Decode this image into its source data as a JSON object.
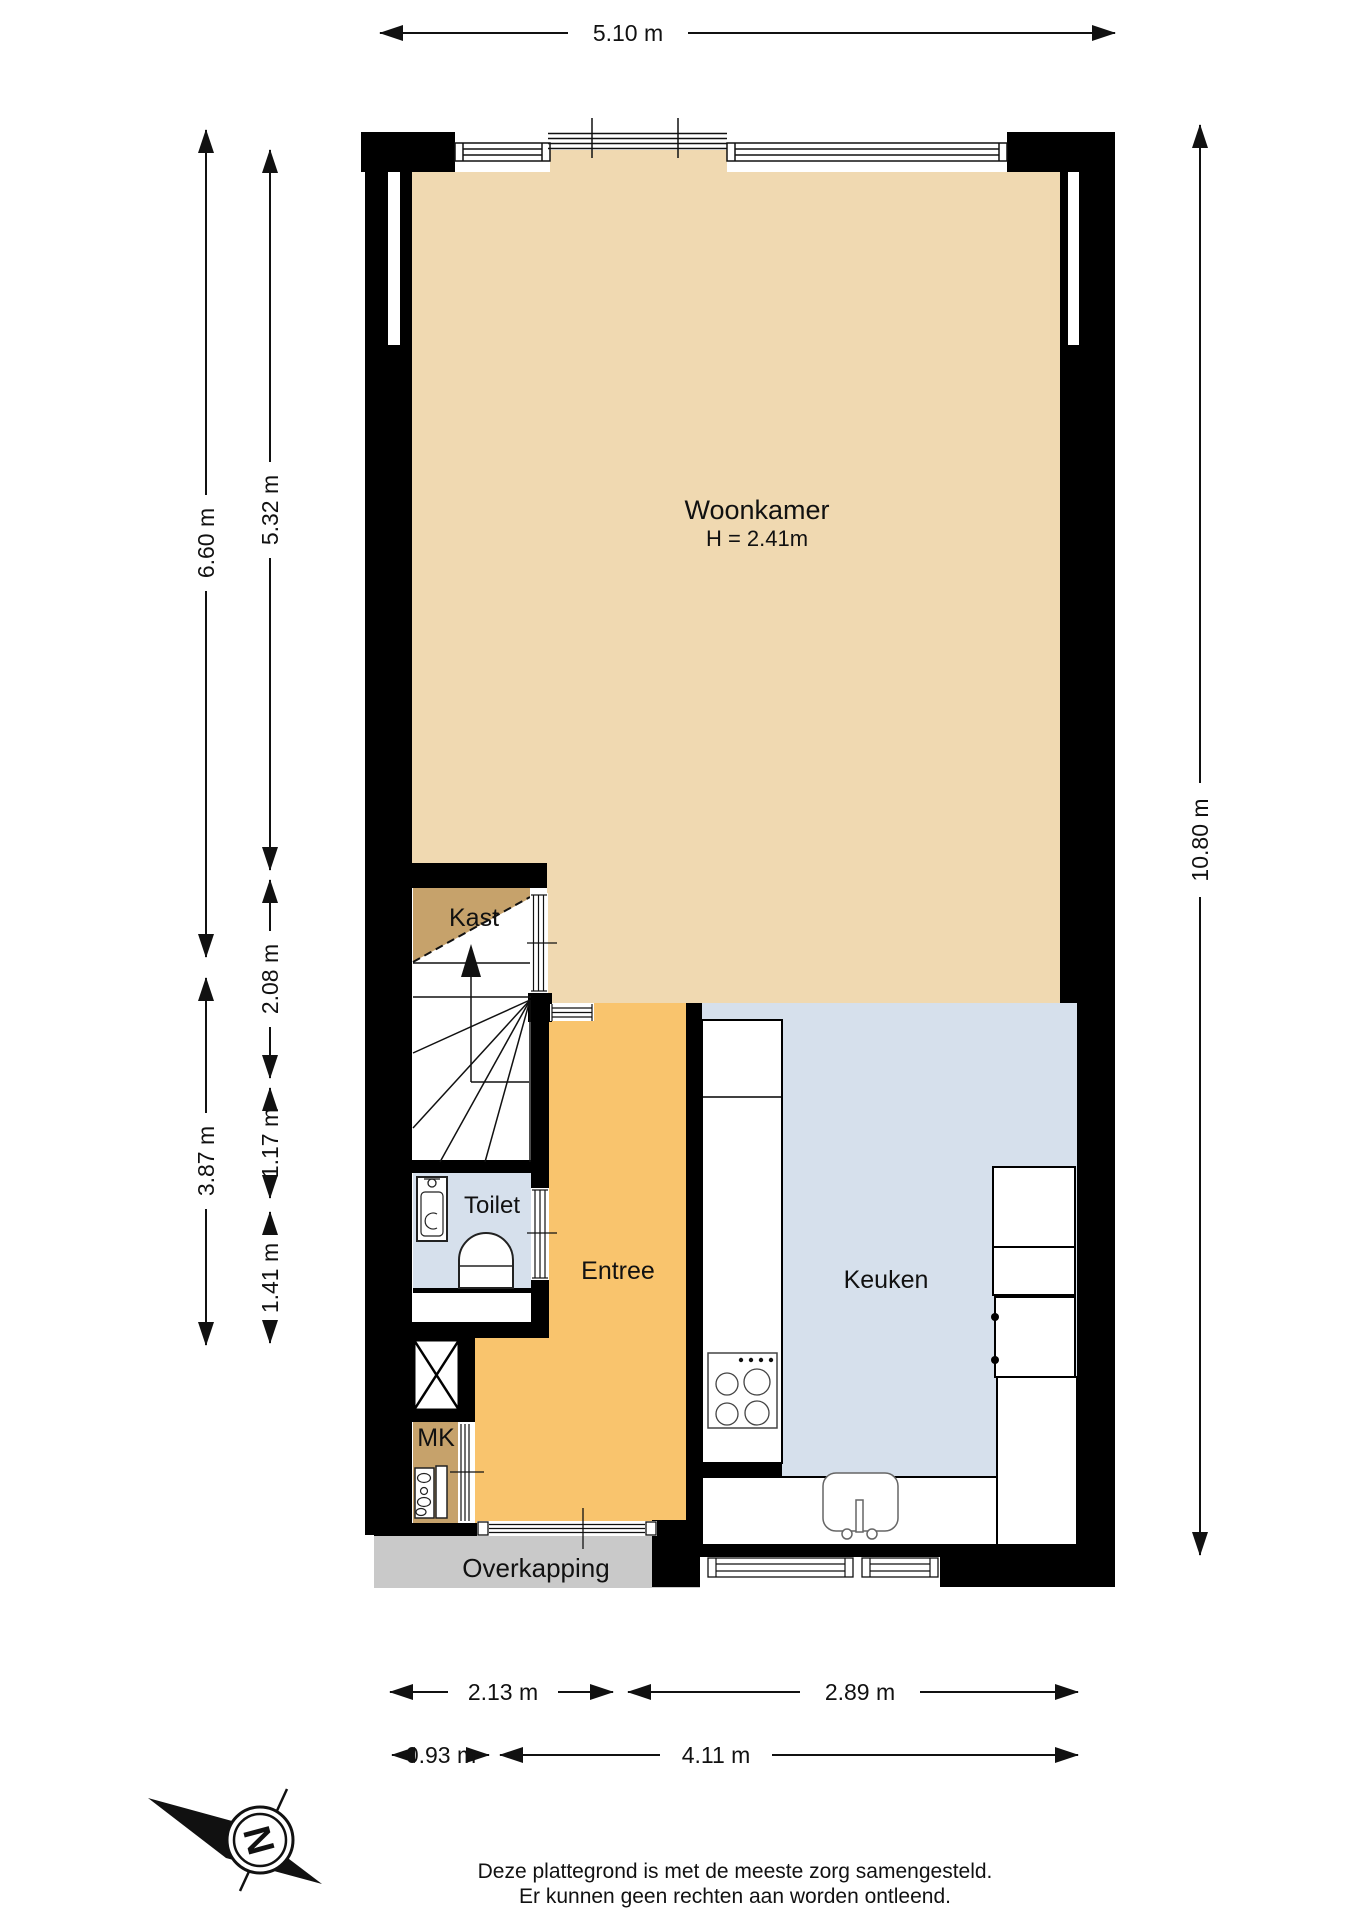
{
  "rooms": {
    "woonkamer": {
      "label": "Woonkamer",
      "height_note": "H = 2.41m"
    },
    "kast": {
      "label": "Kast"
    },
    "toilet": {
      "label": "Toilet"
    },
    "entree": {
      "label": "Entree"
    },
    "keuken": {
      "label": "Keuken"
    },
    "meterkast": {
      "label": "MK"
    },
    "overkapping": {
      "label": "Overkapping"
    }
  },
  "dimensions": {
    "top_width": "5.10 m",
    "left_upper_outer": "6.60 m",
    "left_upper_inner": "5.32 m",
    "left_stairs": "2.08 m",
    "left_toilet": "1.17 m",
    "left_mk": "1.41 m",
    "left_lower_outer": "3.87 m",
    "right_total": "10.80 m",
    "bottom_entree_width": "2.13 m",
    "bottom_keuken_width": "2.89 m",
    "bottom_porch_width": "0.93 m",
    "bottom_facade_width": "4.11 m"
  },
  "compass": {
    "north": "N"
  },
  "footer": {
    "line1": "Deze plattegrond is met de meeste zorg samengesteld.",
    "line2": "Er kunnen geen rechten aan worden ontleend."
  },
  "colors": {
    "wall": "#000000",
    "woonkamer_floor": "#f0d9b1",
    "entree_floor": "#f9c46d",
    "keuken_floor": "#d6e0ec",
    "toilet_floor": "#d6e0ec",
    "kast_floor": "#c6a26b",
    "mk_floor": "#c6a26b",
    "overkapping_floor": "#c9c9c9"
  }
}
